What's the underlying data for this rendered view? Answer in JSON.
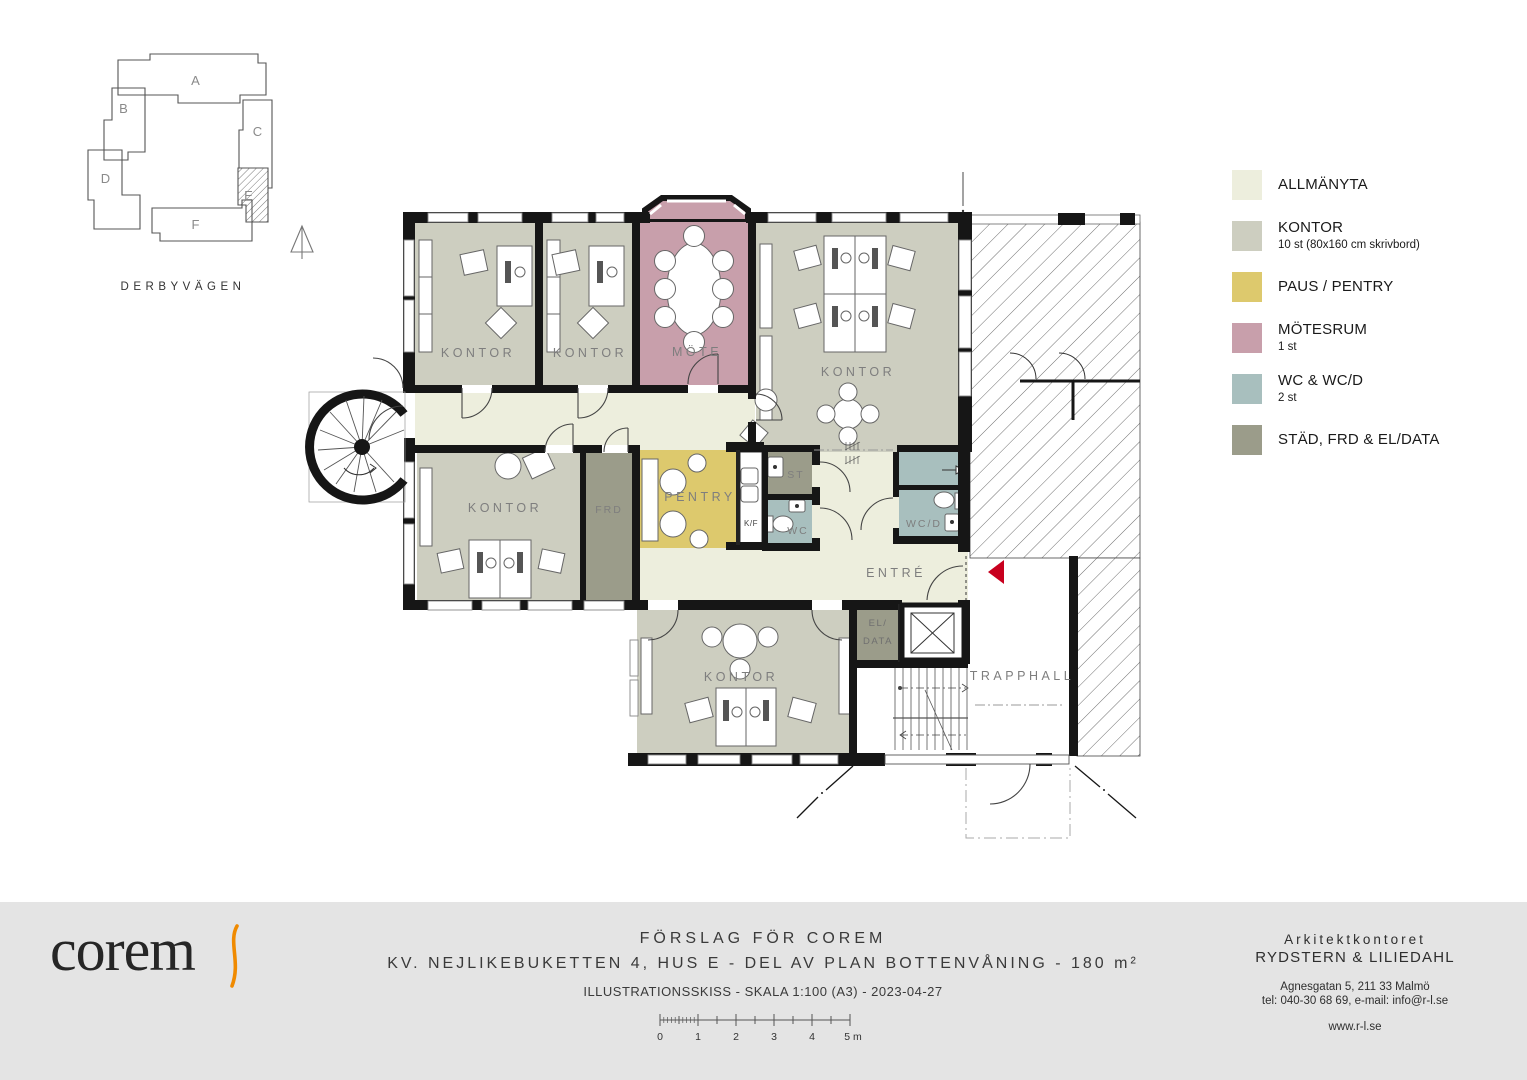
{
  "site_plan": {
    "street": "DERBYVÄGEN",
    "buildings": [
      "A",
      "B",
      "C",
      "D",
      "E",
      "F"
    ]
  },
  "plan": {
    "labels": {
      "kontor1": "KONTOR",
      "kontor2": "KONTOR",
      "mote": "MÖTE",
      "kontor3": "KONTOR",
      "kontor4": "KONTOR",
      "frd": "FRD",
      "pentry": "PENTRY",
      "kf": "K/F",
      "st": "ST",
      "wc": "WC",
      "wcd": "WC/D",
      "entre": "ENTRÉ",
      "eldata_line1": "EL/",
      "eldata_line2": "DATA",
      "kontor5": "KONTOR",
      "trapphall": "TRAPPHALL"
    },
    "colors": {
      "allmanyta": "#edeedd",
      "kontor": "#cdcec0",
      "paus": "#ddc96d",
      "mote": "#c89fab",
      "wc": "#a8bfbe",
      "stad": "#9b9c8a",
      "wall": "#161616",
      "entry_arrow": "#c8001e"
    }
  },
  "legend": {
    "items": [
      {
        "label": "ALLMÄNYTA",
        "sub": "",
        "color": "#edeedd"
      },
      {
        "label": "KONTOR",
        "sub": "10 st (80x160 cm skrivbord)",
        "color": "#cdcec0"
      },
      {
        "label": "PAUS / PENTRY",
        "sub": "",
        "color": "#ddc96d"
      },
      {
        "label": "MÖTESRUM",
        "sub": "1 st",
        "color": "#c89fab"
      },
      {
        "label": "WC & WC/D",
        "sub": "2 st",
        "color": "#a8bfbe"
      },
      {
        "label": "STÄD, FRD & EL/DATA",
        "sub": "",
        "color": "#9b9c8a"
      }
    ]
  },
  "footer": {
    "logo_text": "corem",
    "title": "FÖRSLAG FÖR COREM",
    "subtitle": "KV. NEJLIKEBUKETTEN 4, HUS E - DEL AV PLAN BOTTENVÅNING - 180 m²",
    "note": "ILLUSTRATIONSSKISS - SKALA 1:100 (A3) - 2023-04-27",
    "architect_line1": "Arkitektkontoret",
    "architect_line2": "RYDSTERN & LILIEDAHL",
    "address": "Agnesgatan 5, 211 33 Malmö",
    "contact": "tel: 040-30 68 69, e-mail: info@r-l.se",
    "web": "www.r-l.se",
    "scale_ticks": [
      "0",
      "1",
      "2",
      "3",
      "4",
      "5 m"
    ]
  }
}
